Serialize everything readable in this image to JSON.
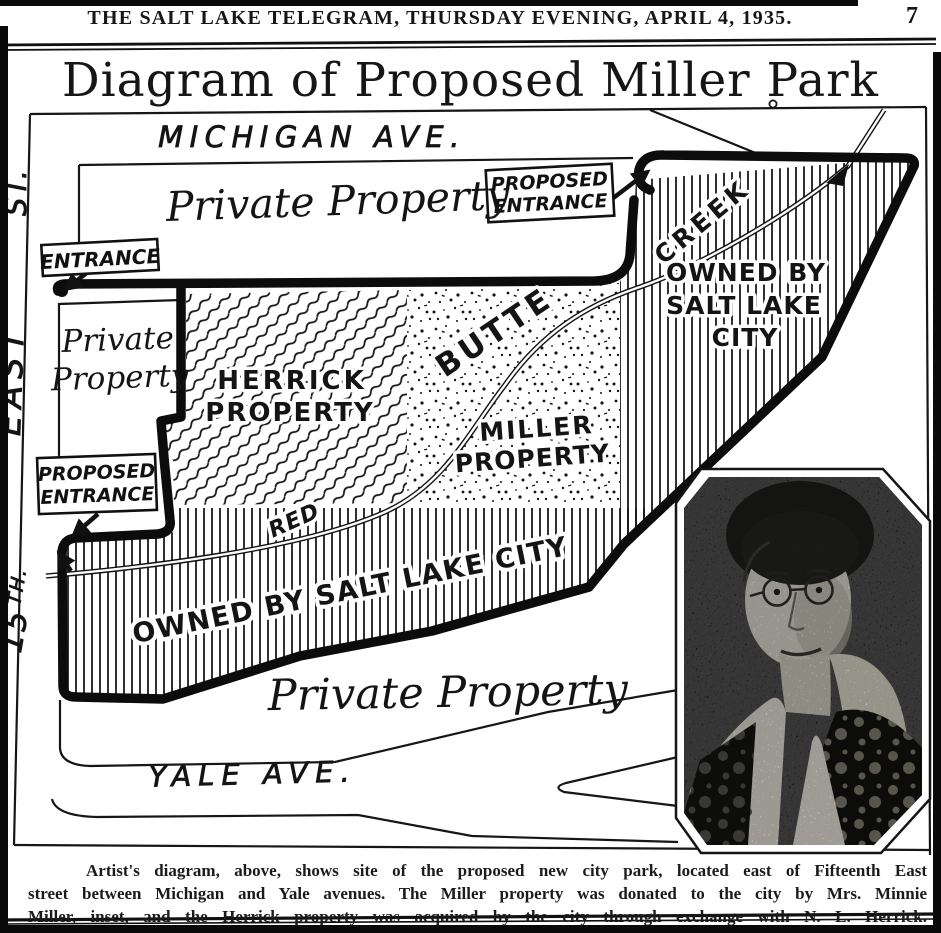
{
  "page": {
    "masthead": "THE SALT LAKE TELEGRAM, THURSDAY EVENING, APRIL 4, 1935.",
    "page_number": "7",
    "title": "Diagram of Proposed Miller Park",
    "caption_lines": [
      "Artist's diagram, above, shows site of the proposed new city park, located east of Fifteenth East",
      "street between Michigan and Yale avenues. The Miller property was donated to the city by Mrs. Minnie",
      "Miller, inset, and the Herrick property was acquired by the city through exchange with N. L. Herrick."
    ]
  },
  "map": {
    "streets": {
      "michigan": "MICHIGAN AVE.",
      "yale": "YALE AVE.",
      "fifteenth": {
        "number": "15",
        "suffix": "TH.",
        "east": "EAST",
        "st": "ST."
      }
    },
    "areas": {
      "private_property_north": "Private Property",
      "private_property_west": [
        "Private",
        "Property"
      ],
      "private_property_south": "Private Property",
      "herrick": [
        "HERRICK",
        "PROPERTY"
      ],
      "miller": [
        "MILLER",
        "PROPERTY"
      ],
      "owned_by_city_east": [
        "OWNED BY",
        "SALT LAKE",
        "CITY"
      ],
      "owned_by_city_south": "OWNED BY SALT LAKE CITY"
    },
    "creek": {
      "red": "RED",
      "butte": "BUTTE",
      "creek": "CREEK"
    },
    "markers": {
      "entrance": "ENTRANCE",
      "proposed_entrance_north": [
        "PROPOSED",
        "ENTRANCE"
      ],
      "proposed_entrance_west": [
        "PROPOSED",
        "ENTRANCE"
      ]
    },
    "inset": {
      "description": "Halftone inset portrait photograph"
    }
  },
  "colors": {
    "ink": "#161616",
    "paper": "#ffffff"
  }
}
